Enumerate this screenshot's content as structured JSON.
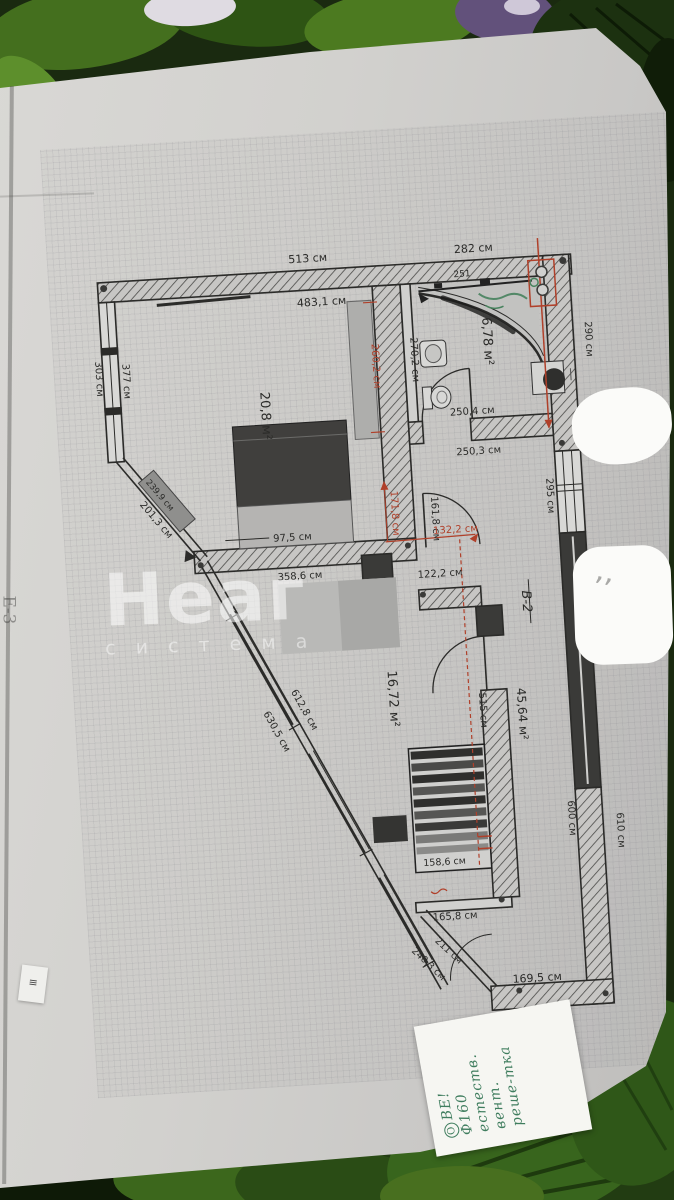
{
  "photo": {
    "paper_color": "#d3d2cf",
    "ink_red": "#b0402a",
    "ink_green": "#3f7d5e",
    "plan_line": "#2b2b29"
  },
  "watermark": {
    "line1": "Неаг",
    "line2": "с и с т е м а"
  },
  "margin_note": "Е-3",
  "sticker_glyph": "≡",
  "smudge_marks": "’’",
  "note": {
    "badge": "О",
    "lines": [
      "ВЕ!",
      "Ф160",
      "естеств.",
      "вент.",
      "реше-",
      "тка"
    ]
  },
  "plan": {
    "bedroom": {
      "area": "20,8 м²",
      "top_outer": "513 см",
      "top_inner": "483,1 см",
      "left_inner": "377 см",
      "left_outer": "303 см",
      "right": "260,2 см",
      "diag_wall": "201,3 см",
      "cabinet": "239,9 см",
      "bed_gap": "97,5 см"
    },
    "bathroom": {
      "area": "6,78 м²",
      "top": "282 см",
      "right": "290 см",
      "left": "270,2 см",
      "bottom": "250,4 см",
      "bath_width": "251"
    },
    "hall": {
      "name": "В-2",
      "top": "250,3 см",
      "h1": "161,8 см",
      "h1_red": "171,8 см",
      "w_red": "132,2 см",
      "w2": "122,2 см",
      "window": "295 см",
      "length": "515 см",
      "area_note": "45,64 м²",
      "right_inner": "600 см",
      "right_outer": "610 см"
    },
    "living": {
      "area": "16,72 м²",
      "top": "358,6 см",
      "diag_inner": "612,8 см",
      "diag_outer": "630,5 см",
      "radiator": "158,6 см",
      "bottom1": "165,8 см",
      "diag2_inner": "211 см",
      "diag2_outer": "240,3 см",
      "bottom2": "169,5 см"
    }
  }
}
